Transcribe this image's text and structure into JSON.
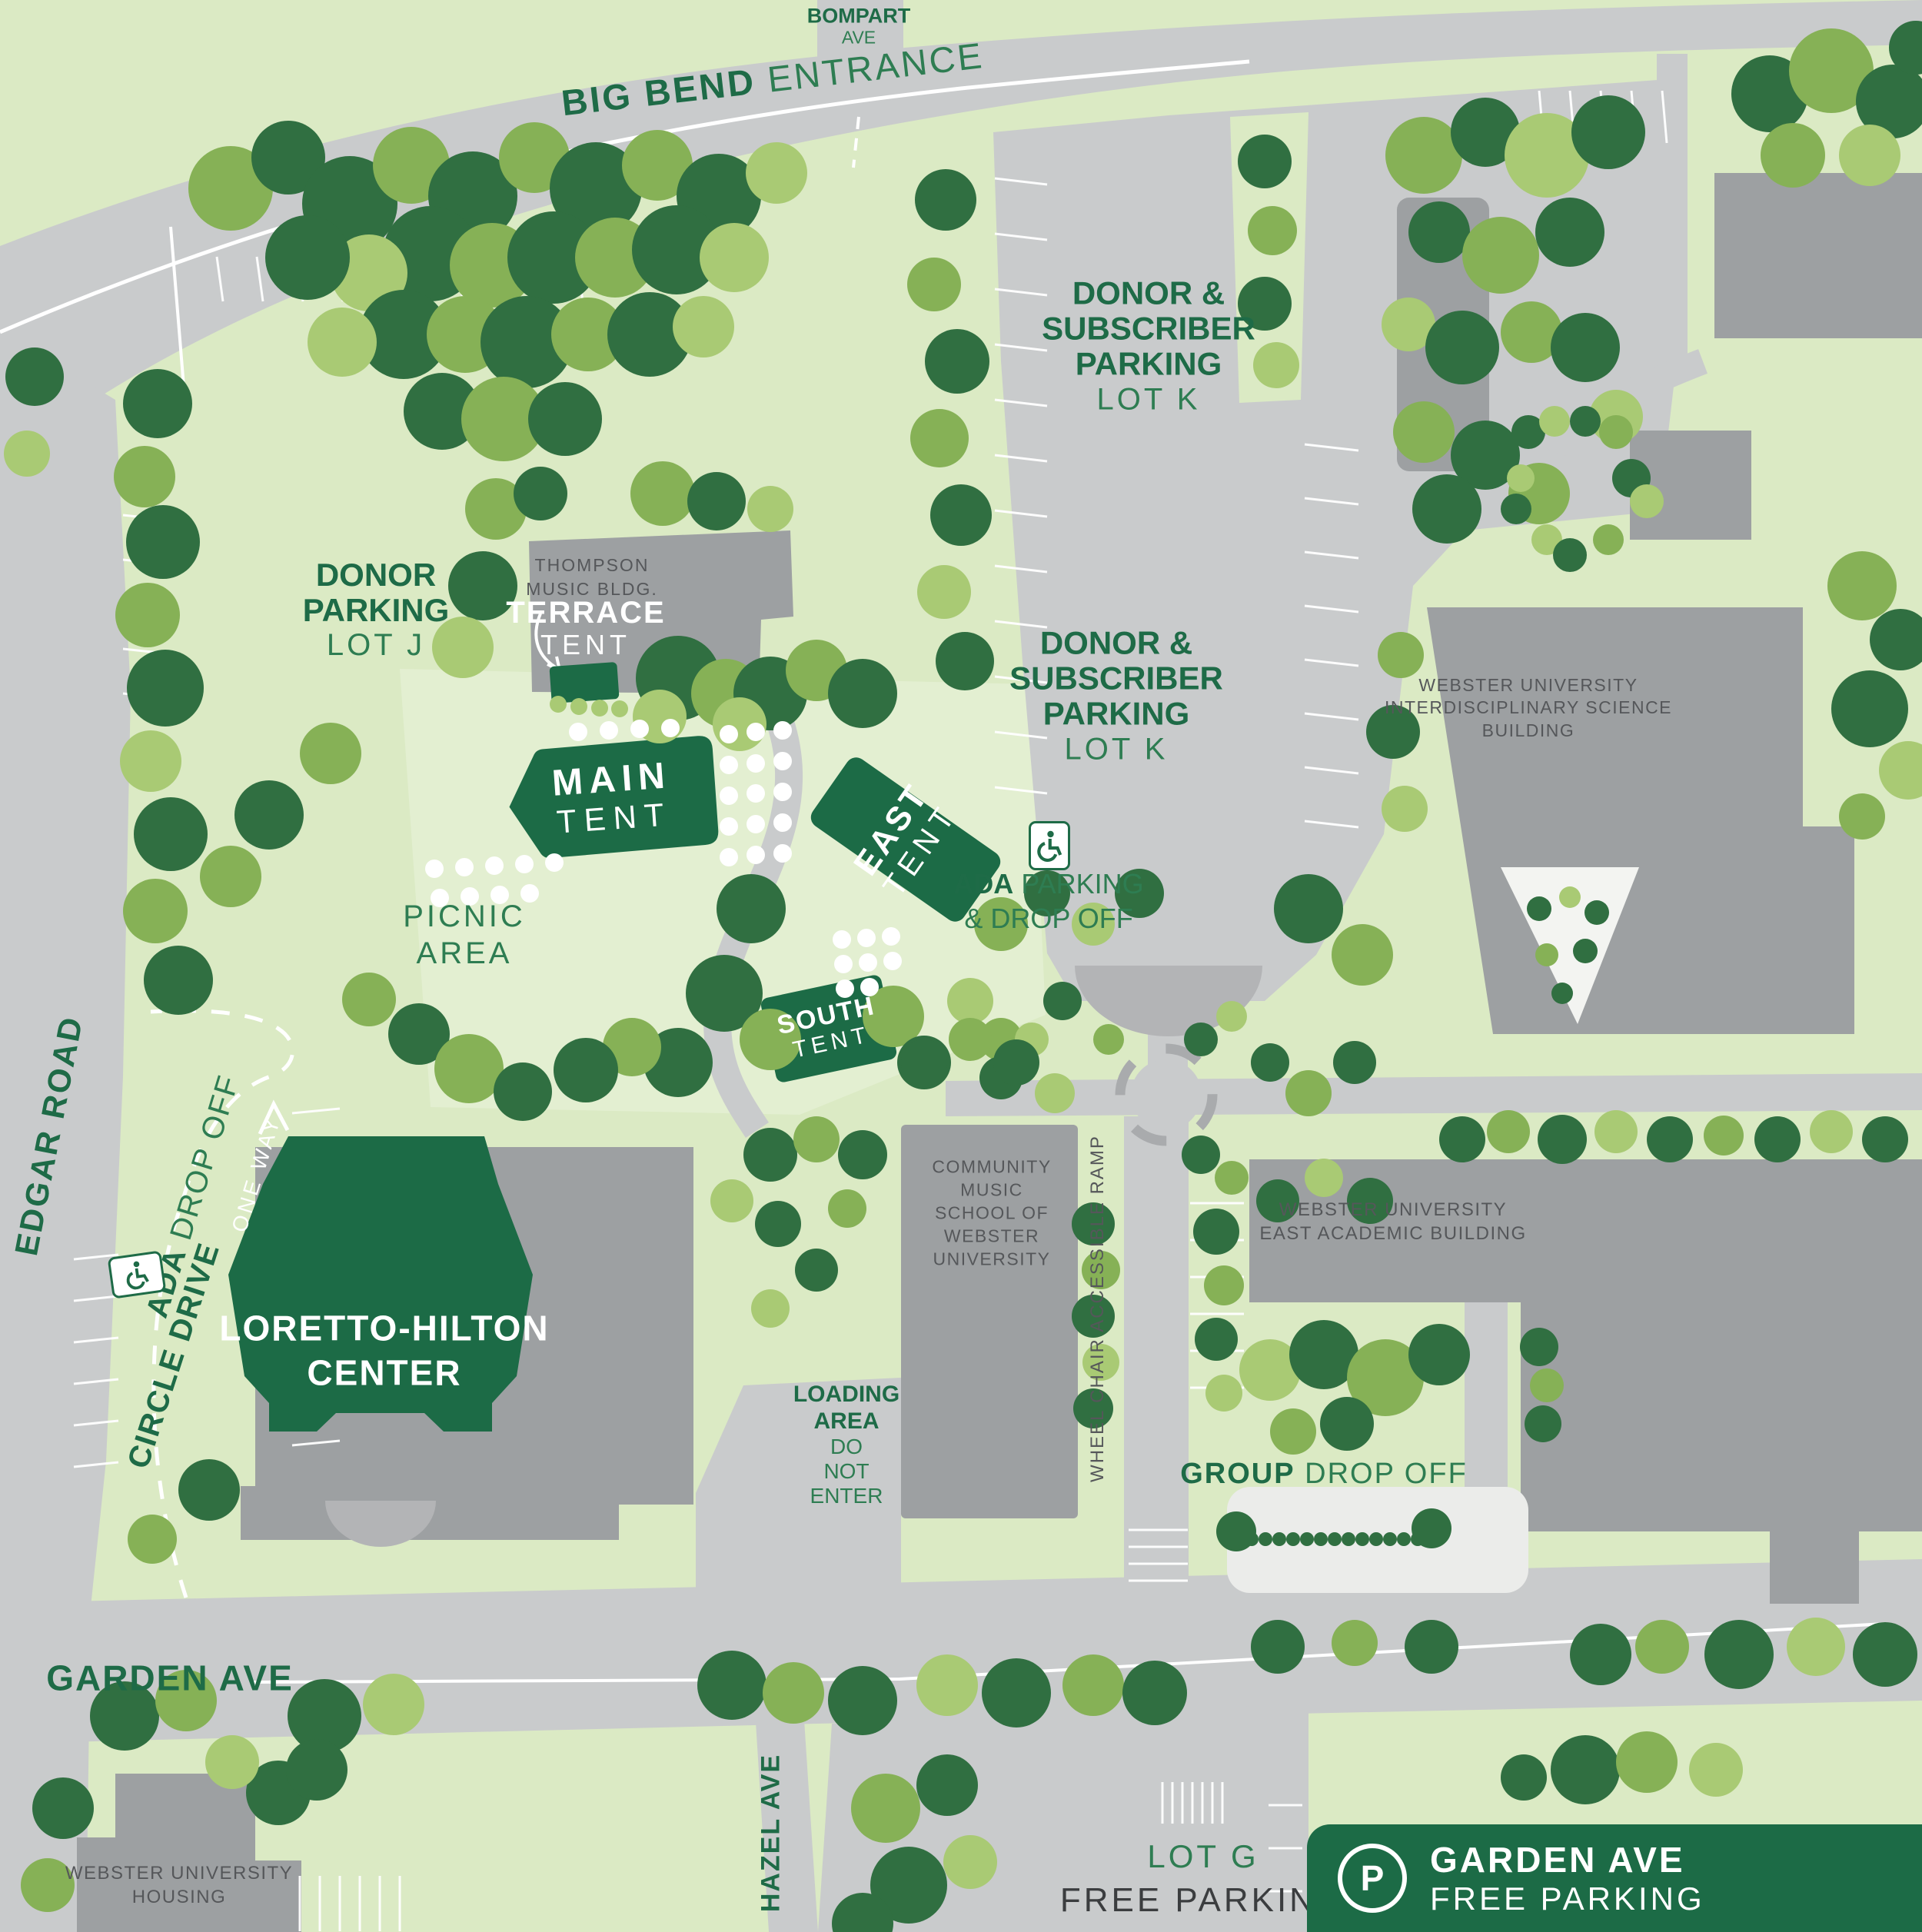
{
  "streets": {
    "bompart": [
      "BOMPART",
      "AVE"
    ],
    "big_bend": {
      "bold": "BIG BEND",
      "rest": "ENTRANCE"
    },
    "edgar": "EDGAR ROAD",
    "circle_drive": "CIRCLE DRIVE",
    "one_way": "ONE WAY",
    "garden": "GARDEN AVE",
    "hazel": "HAZEL AVE"
  },
  "parking": {
    "lot_k_upper": [
      "DONOR &",
      "SUBSCRIBER",
      "PARKING",
      "LOT K"
    ],
    "lot_k_lower": [
      "DONOR &",
      "SUBSCRIBER",
      "PARKING",
      "LOT K"
    ],
    "lot_j": [
      "DONOR",
      "PARKING",
      "LOT J"
    ],
    "ada_parking": {
      "bold": "ADA",
      "rest": "PARKING",
      "line2": "& DROP OFF"
    },
    "ada_drop_off": {
      "bold": "ADA",
      "rest": "DROP OFF"
    },
    "group_drop_off": {
      "bold": "GROUP",
      "rest": "DROP OFF"
    },
    "lot_g": {
      "name": "LOT G",
      "desc": "FREE PARKING"
    }
  },
  "tents": {
    "terrace": [
      "TERRACE",
      "TENT"
    ],
    "main": [
      "MAIN",
      "TENT"
    ],
    "east": [
      "EAST",
      "TENT"
    ],
    "south": [
      "SOUTH",
      "TENT"
    ]
  },
  "buildings": {
    "thompson": [
      "THOMPSON",
      "MUSIC BLDG."
    ],
    "loretto": [
      "LORETTO-HILTON",
      "CENTER"
    ],
    "community_music": [
      "COMMUNITY",
      "MUSIC",
      "SCHOOL OF",
      "WEBSTER",
      "UNIVERSITY"
    ],
    "science": [
      "WEBSTER UNIVERSITY",
      "INTERDISCIPLINARY SCIENCE",
      "BUILDING"
    ],
    "east_academic": [
      "WEBSTER UNIVERSITY",
      "EAST ACADEMIC BUILDING"
    ],
    "housing": [
      "WEBSTER UNIVERSITY",
      "HOUSING"
    ]
  },
  "areas": {
    "picnic": [
      "PICNIC",
      "AREA"
    ],
    "loading": {
      "bold": [
        "LOADING",
        "AREA"
      ],
      "rest": [
        "DO",
        "NOT",
        "ENTER"
      ]
    },
    "ramp": "WHEEL CHAIR ACCESSIBLE RAMP"
  },
  "legend_badge": {
    "icon_letter": "P",
    "line1": "GARDEN AVE",
    "line2": "FREE PARKING"
  },
  "colors": {
    "brand_green": "#1c6b46",
    "label_green": "#2e7d52",
    "ground": "#dbeac4",
    "road": "#c9cbcc",
    "building": "#9da0a2",
    "tree_dark": "#306f41",
    "tree_mid": "#86b156",
    "tree_light": "#a9ca74"
  }
}
